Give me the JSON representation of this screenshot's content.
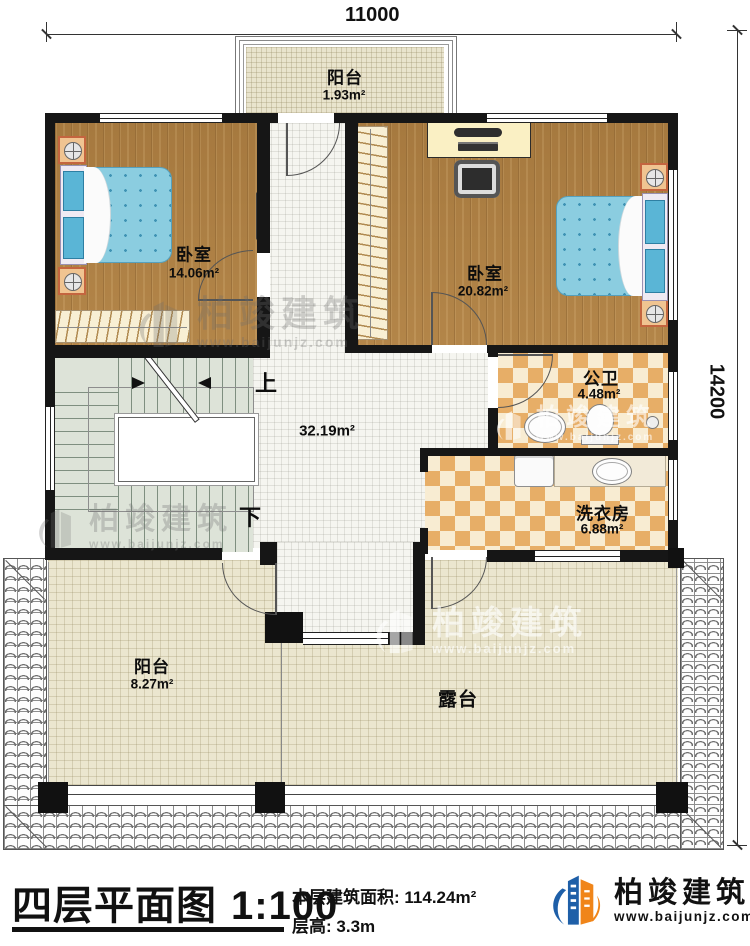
{
  "dims": {
    "top": "11000",
    "right": "14200"
  },
  "rooms": {
    "balcony_top": {
      "name": "阳台",
      "area": "1.93m²"
    },
    "bedroom_left": {
      "name": "卧室",
      "area": "14.06m²"
    },
    "bedroom_right": {
      "name": "卧室",
      "area": "20.82m²"
    },
    "bathroom": {
      "name": "公卫",
      "area": "4.48m²"
    },
    "laundry": {
      "name": "洗衣房",
      "area": "6.88m²"
    },
    "hall": {
      "area": "32.19m²"
    },
    "balcony_bottom": {
      "name": "阳台",
      "area": "8.27m²"
    },
    "terrace": {
      "name": "露台"
    }
  },
  "stairs": {
    "up_label": "上",
    "down_label": "下"
  },
  "footer": {
    "title": "四层平面图",
    "scale": "1:100",
    "floor_area_label": "本层建筑面积:",
    "floor_area_value": "114.24m²",
    "floor_height_label": "层高:",
    "floor_height_value": "3.3m"
  },
  "brand": {
    "name": "柏竣建筑",
    "website": "www.baijunjz.com"
  },
  "colors": {
    "wall": "#161616",
    "wood": "#b08348",
    "bed": "#8ccfe3",
    "checker": "#e7ae67",
    "logo_blue": "#1e5fa8",
    "logo_orange": "#f08519"
  }
}
